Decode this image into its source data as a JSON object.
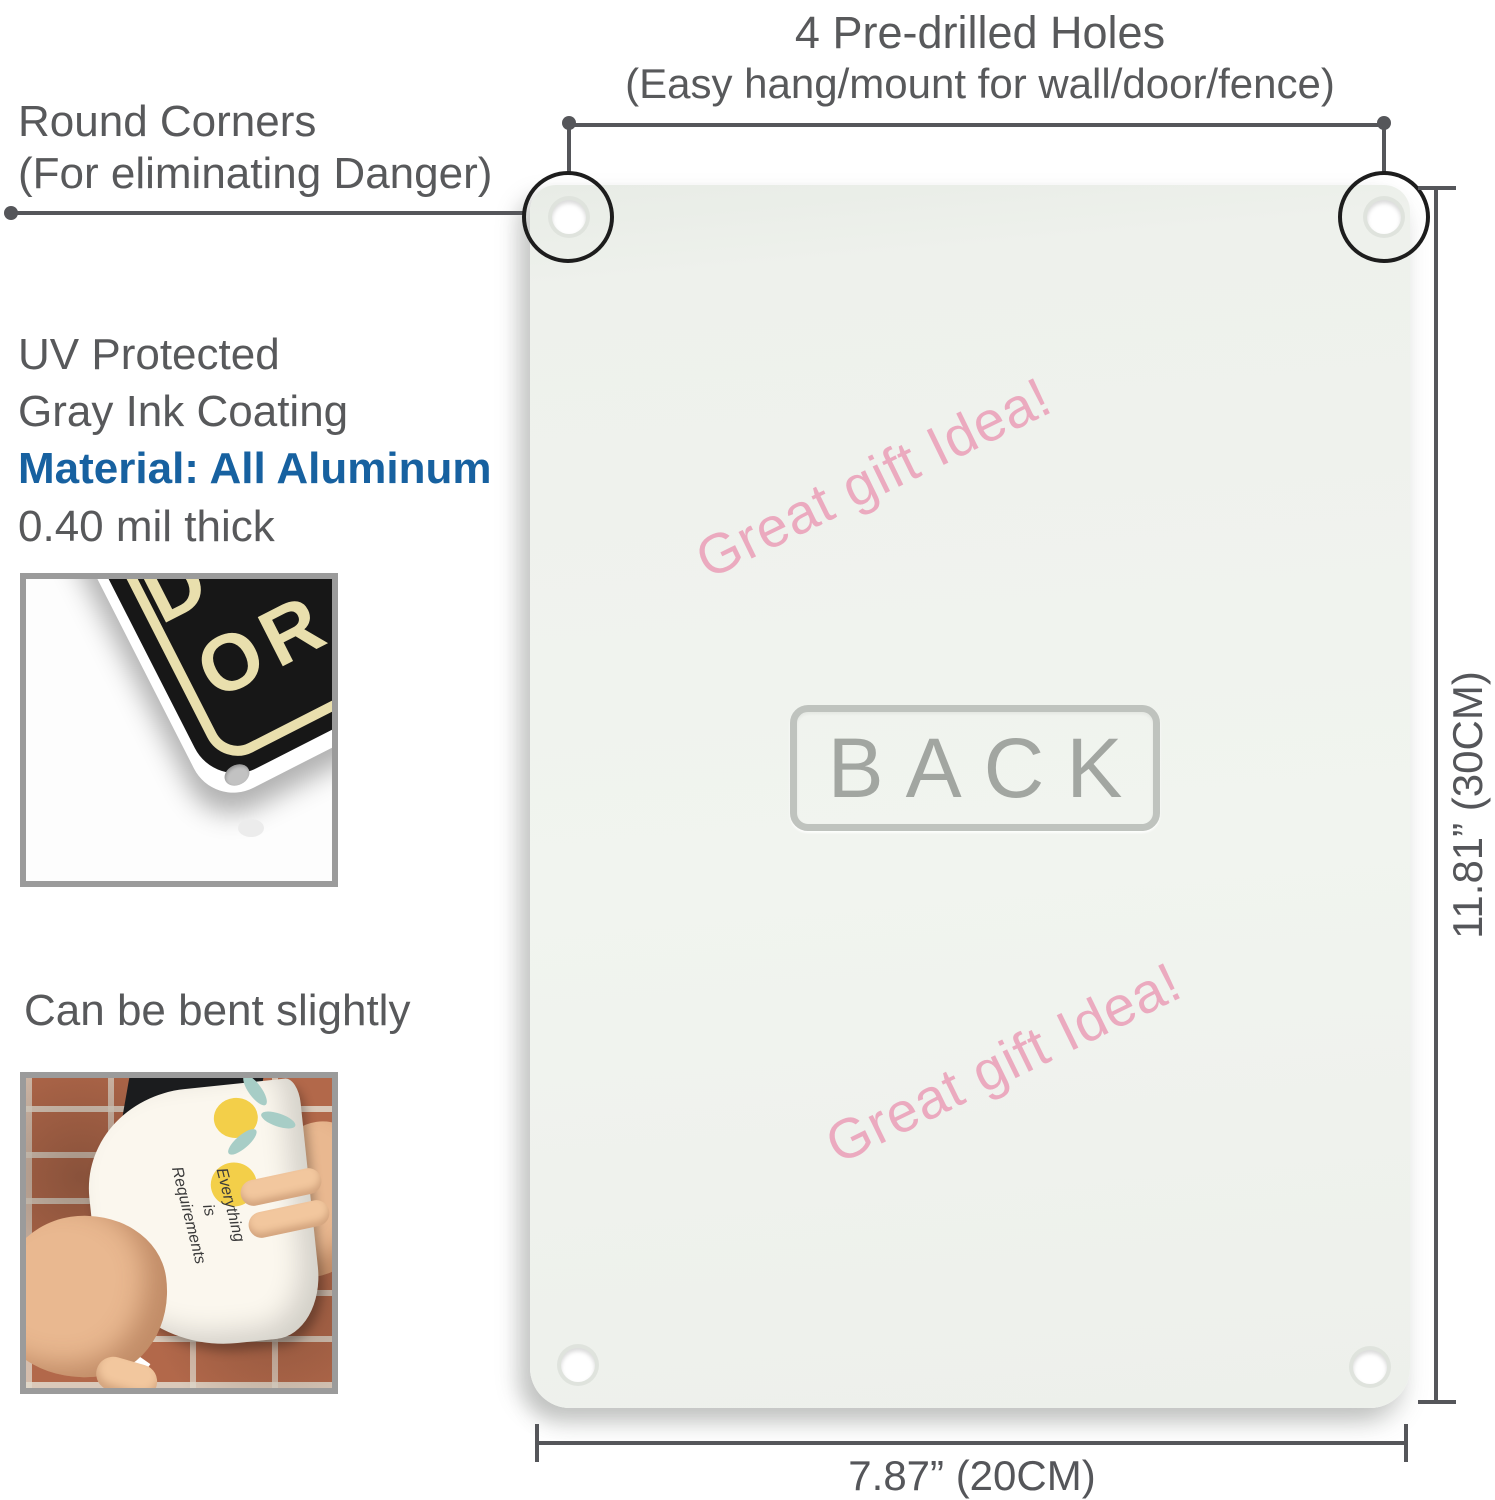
{
  "header": {
    "predrilled_line1": "4 Pre-drilled Holes",
    "predrilled_line2": "(Easy hang/mount for wall/door/fence)"
  },
  "left_column": {
    "round_corners_line1": "Round Corners",
    "round_corners_line2": "(For eliminating Danger)",
    "coating_line1": "UV Protected",
    "coating_line2": "Gray Ink Coating",
    "material_line": "Material: All Aluminum",
    "thickness_line": "0.40 mil thick",
    "bend_caption": "Can be bent slightly"
  },
  "photo_corner_sign": {
    "letters_row1": "D",
    "letters_row2": "OR R"
  },
  "photo_bend": {
    "script_line1": "Everything",
    "script_line2": "is",
    "script_line3": "Requirements"
  },
  "panel": {
    "back_label": "BACK",
    "watermark_top": "Great gift Idea!",
    "watermark_bottom": "Great gift Idea!"
  },
  "dimensions": {
    "height_label": "11.81” (30CM)",
    "width_label": "7.87” (20CM)"
  },
  "colors": {
    "text_gray": "#58595b",
    "accent_blue": "#1761a0",
    "watermark_pink": "#ebaabf",
    "panel_bg": "#eff2ed",
    "annotation_line": "#55565a",
    "sign_black": "#171717",
    "sign_cream": "#e9dfad"
  }
}
